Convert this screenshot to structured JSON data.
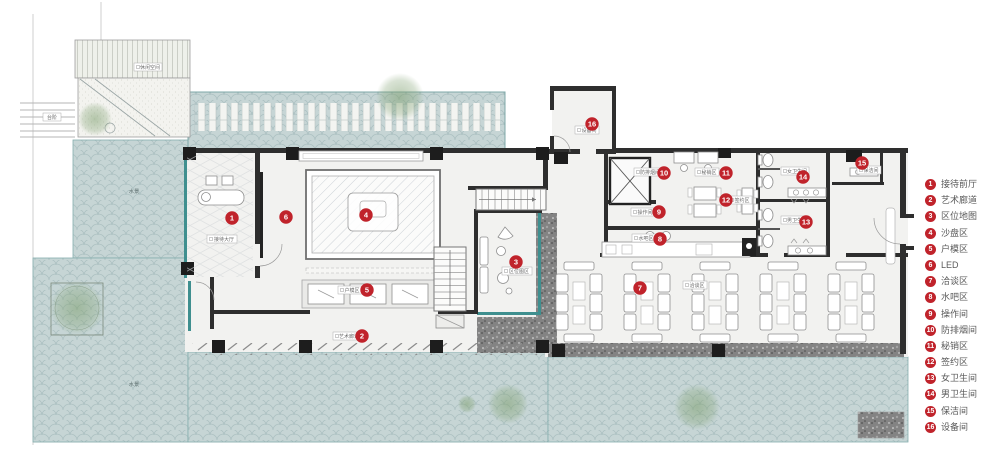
{
  "colors": {
    "marker_red": "#c0232b",
    "water": "#c6d5d5",
    "water_edge": "#7fa8a8",
    "glass_teal": "#3f8f8f",
    "wall": "#2e2e2e",
    "gravel": "#838383",
    "floor": "#f2f2f0",
    "tree_green": "#7fa070"
  },
  "legend": {
    "items": [
      {
        "num": "1",
        "label": "接待前厅"
      },
      {
        "num": "2",
        "label": "艺术廊道"
      },
      {
        "num": "3",
        "label": "区位地图"
      },
      {
        "num": "4",
        "label": "沙盘区"
      },
      {
        "num": "5",
        "label": "户模区"
      },
      {
        "num": "6",
        "label": "LED"
      },
      {
        "num": "7",
        "label": "洽谈区"
      },
      {
        "num": "8",
        "label": "水吧区"
      },
      {
        "num": "9",
        "label": "操作间"
      },
      {
        "num": "10",
        "label": "防排烟间"
      },
      {
        "num": "11",
        "label": "秘销区"
      },
      {
        "num": "12",
        "label": "签约区"
      },
      {
        "num": "13",
        "label": "女卫生间"
      },
      {
        "num": "14",
        "label": "男卫生间"
      },
      {
        "num": "15",
        "label": "保洁间"
      },
      {
        "num": "16",
        "label": "设备间"
      }
    ]
  },
  "plan": {
    "markers": [
      {
        "num": "1"
      },
      {
        "num": "2"
      },
      {
        "num": "3"
      },
      {
        "num": "4"
      },
      {
        "num": "5"
      },
      {
        "num": "6"
      },
      {
        "num": "7"
      },
      {
        "num": "8"
      },
      {
        "num": "9"
      },
      {
        "num": "10"
      },
      {
        "num": "11"
      },
      {
        "num": "12"
      },
      {
        "num": "13"
      },
      {
        "num": "14"
      },
      {
        "num": "15"
      },
      {
        "num": "16"
      }
    ],
    "room_labels": [
      {
        "text": "接待大厅"
      },
      {
        "text": "区位图区"
      },
      {
        "text": "户模区"
      },
      {
        "text": "艺术廊道"
      },
      {
        "text": "洽谈区"
      },
      {
        "text": "操作间"
      },
      {
        "text": "水吧区"
      },
      {
        "text": "秘销区"
      },
      {
        "text": "签约区"
      },
      {
        "text": "防排烟间"
      },
      {
        "text": "女卫生间"
      },
      {
        "text": "男卫生间"
      },
      {
        "text": "保洁间"
      },
      {
        "text": "设备间"
      },
      {
        "text": "水景"
      },
      {
        "text": "水景"
      },
      {
        "text": "台阶"
      },
      {
        "text": "休闲空间"
      }
    ]
  }
}
